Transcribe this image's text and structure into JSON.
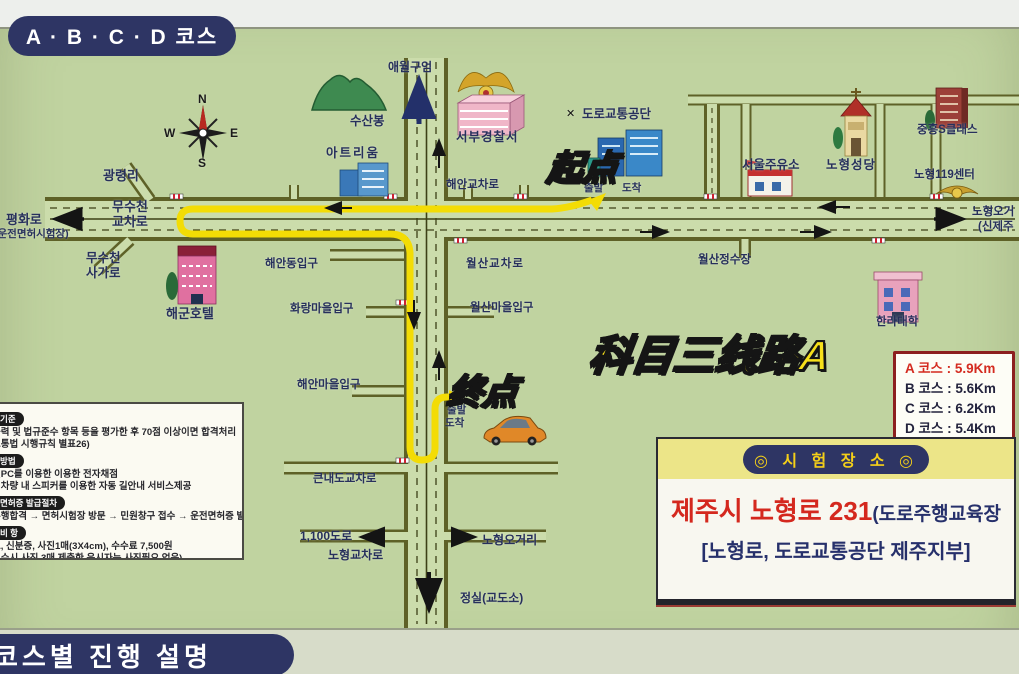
{
  "header": {
    "course_pill": "A · B · C · D 코스"
  },
  "footer": {
    "pill": "코스별 진행 설명"
  },
  "map": {
    "compass": {
      "n": "N",
      "e": "E",
      "s": "S",
      "w": "W"
    },
    "labels": {
      "gwangnyeongri": "광령리",
      "pyeonghwaro": "평화로",
      "license_site": "(운전면허시험장)",
      "musucheon": "무수천\n교차로",
      "musucheon_sagaro": "무수천\n사가로",
      "haegun_hotel": "해군호텔",
      "susanbong": "수산봉",
      "atrium": "아트리움",
      "aewol_gueom": "애월구엄",
      "seobu_police": "서부경찰서",
      "doro_gongdan": "도로교통공단",
      "doro_logo": "✕",
      "chulbal_top": "출발",
      "dochak_top": "도착",
      "haean_gyocharo": "해안교차로",
      "seoul_gas": "서울주유소",
      "nohyeong_cathedral": "노형성당",
      "jungheung": "중흥S클래스",
      "nohyeong119": "노형119센터",
      "shinjeju_line1": "노형오거",
      "shinjeju_line2": "(신제주",
      "wolsan_water": "월산정수장",
      "wolsan_gyocharo": "월산교차로",
      "wolsan_village": "월산마을입구",
      "halla_univ": "한라대학",
      "haean_dong": "해안동입구",
      "hwarang_village": "화랑마을입구",
      "haean_village": "해안마을입구",
      "chulbal_mid": "출발",
      "dochak_mid": "도착",
      "keunnaedo": "큰내도교차로",
      "road1100": "1,100도로",
      "nohyeong_gyocharo": "노형교차로",
      "nohyeong_ogeori": "노형오거리",
      "jeongsil": "정실(교도소)"
    },
    "annotations": {
      "start": "起点",
      "end": "终点",
      "route_title": "科目三线路A"
    },
    "legend": {
      "sep": ":",
      "rows": [
        {
          "label": "A 코스",
          "value": "5.9Km"
        },
        {
          "label": "B 코스",
          "value": "5.6Km"
        },
        {
          "label": "C 코스",
          "value": "6.2Km"
        },
        {
          "label": "D 코스",
          "value": "5.4Km"
        }
      ]
    }
  },
  "exam_box": {
    "title": "◎ 시 험 장 소 ◎",
    "address_main": "제주시 노형로 231",
    "address_paren": "(도로주행교육장",
    "address_sub": "[노형로, 도로교통공단 제주지부]"
  },
  "info_box": {
    "sections": [
      {
        "tag": "기준",
        "lines": [
          "능력 및 법규준수 항목 등을 평가한 후 70점 이상이면 합격처리",
          "교통법 시행규칙 별표26)"
        ]
      },
      {
        "tag": "방법",
        "lines": [
          "릿PC를 이용한 이용한 전자채점",
          "험차량 내 스피커를 이용한 자동 길안내 서비스제공"
        ]
      },
      {
        "tag": "면허증 발급절차",
        "lines": [
          "주행합격 → 면허시험장 방문 → 민원창구 접수 → 운전면허증 발급"
        ]
      },
      {
        "tag": "비 항",
        "lines": [
          "표, 신분증, 사진1매(3X4cm), 수수료 7,500원",
          "접수시 사진 3매 제출한 응시자는 사진필요 없음)",
          "전면허증 교부전 운전시 무면허로 형사처벌"
        ]
      }
    ]
  },
  "colors": {
    "route_yellow": "#f3dc05",
    "pill_navy": "#2e3564",
    "legend_red": "#d42b20",
    "map_green": "#c0d3a0"
  }
}
